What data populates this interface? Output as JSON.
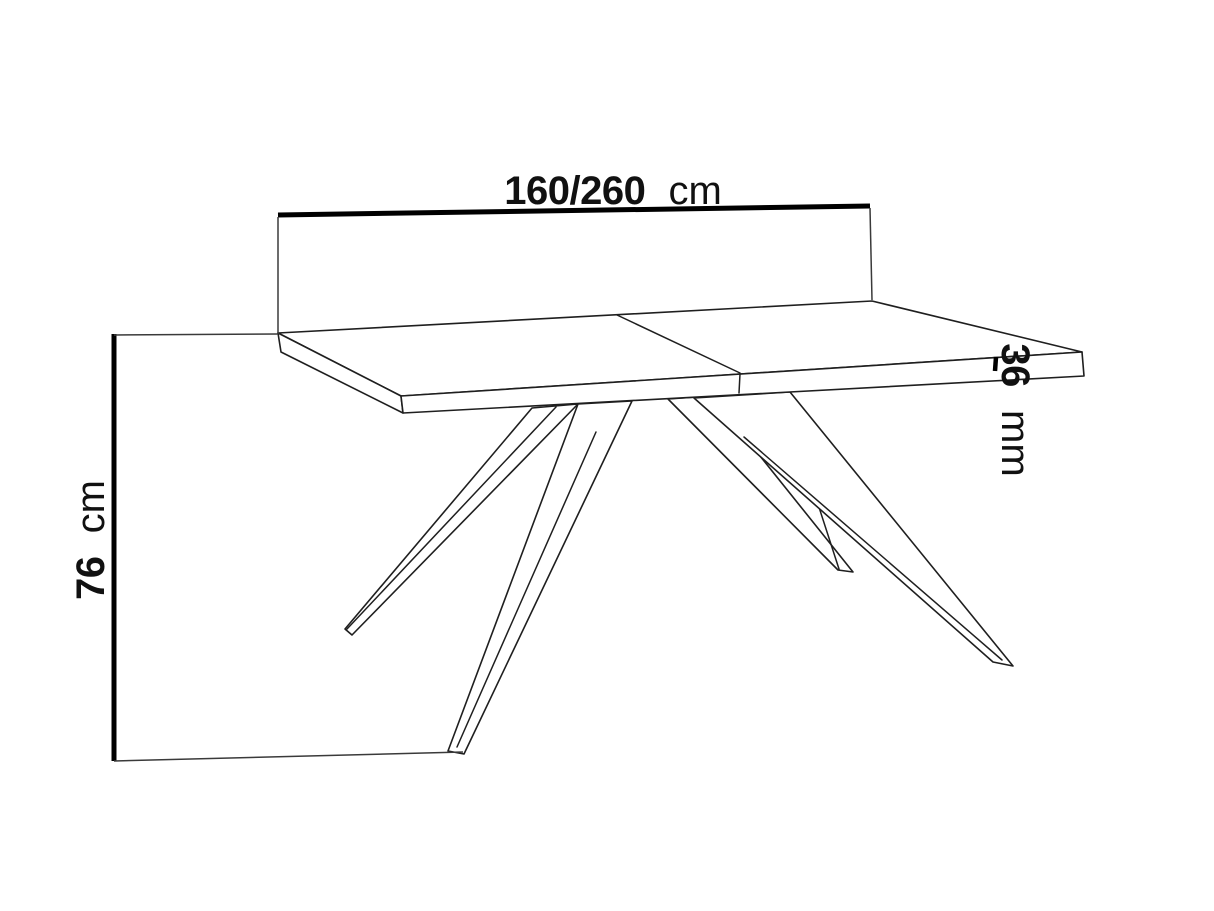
{
  "drawing": {
    "description": "Technical line drawing of an extendable dining table with four splayed spider legs and dimension callouts",
    "background_color": "#ffffff",
    "line_color": "#1f1f1f",
    "dimension_color": "#000000"
  },
  "dims": {
    "width": {
      "value": "160/260",
      "unit": "cm"
    },
    "height": {
      "value": "76",
      "unit": "cm"
    },
    "thickness": {
      "value": "36",
      "unit": "mm"
    }
  }
}
